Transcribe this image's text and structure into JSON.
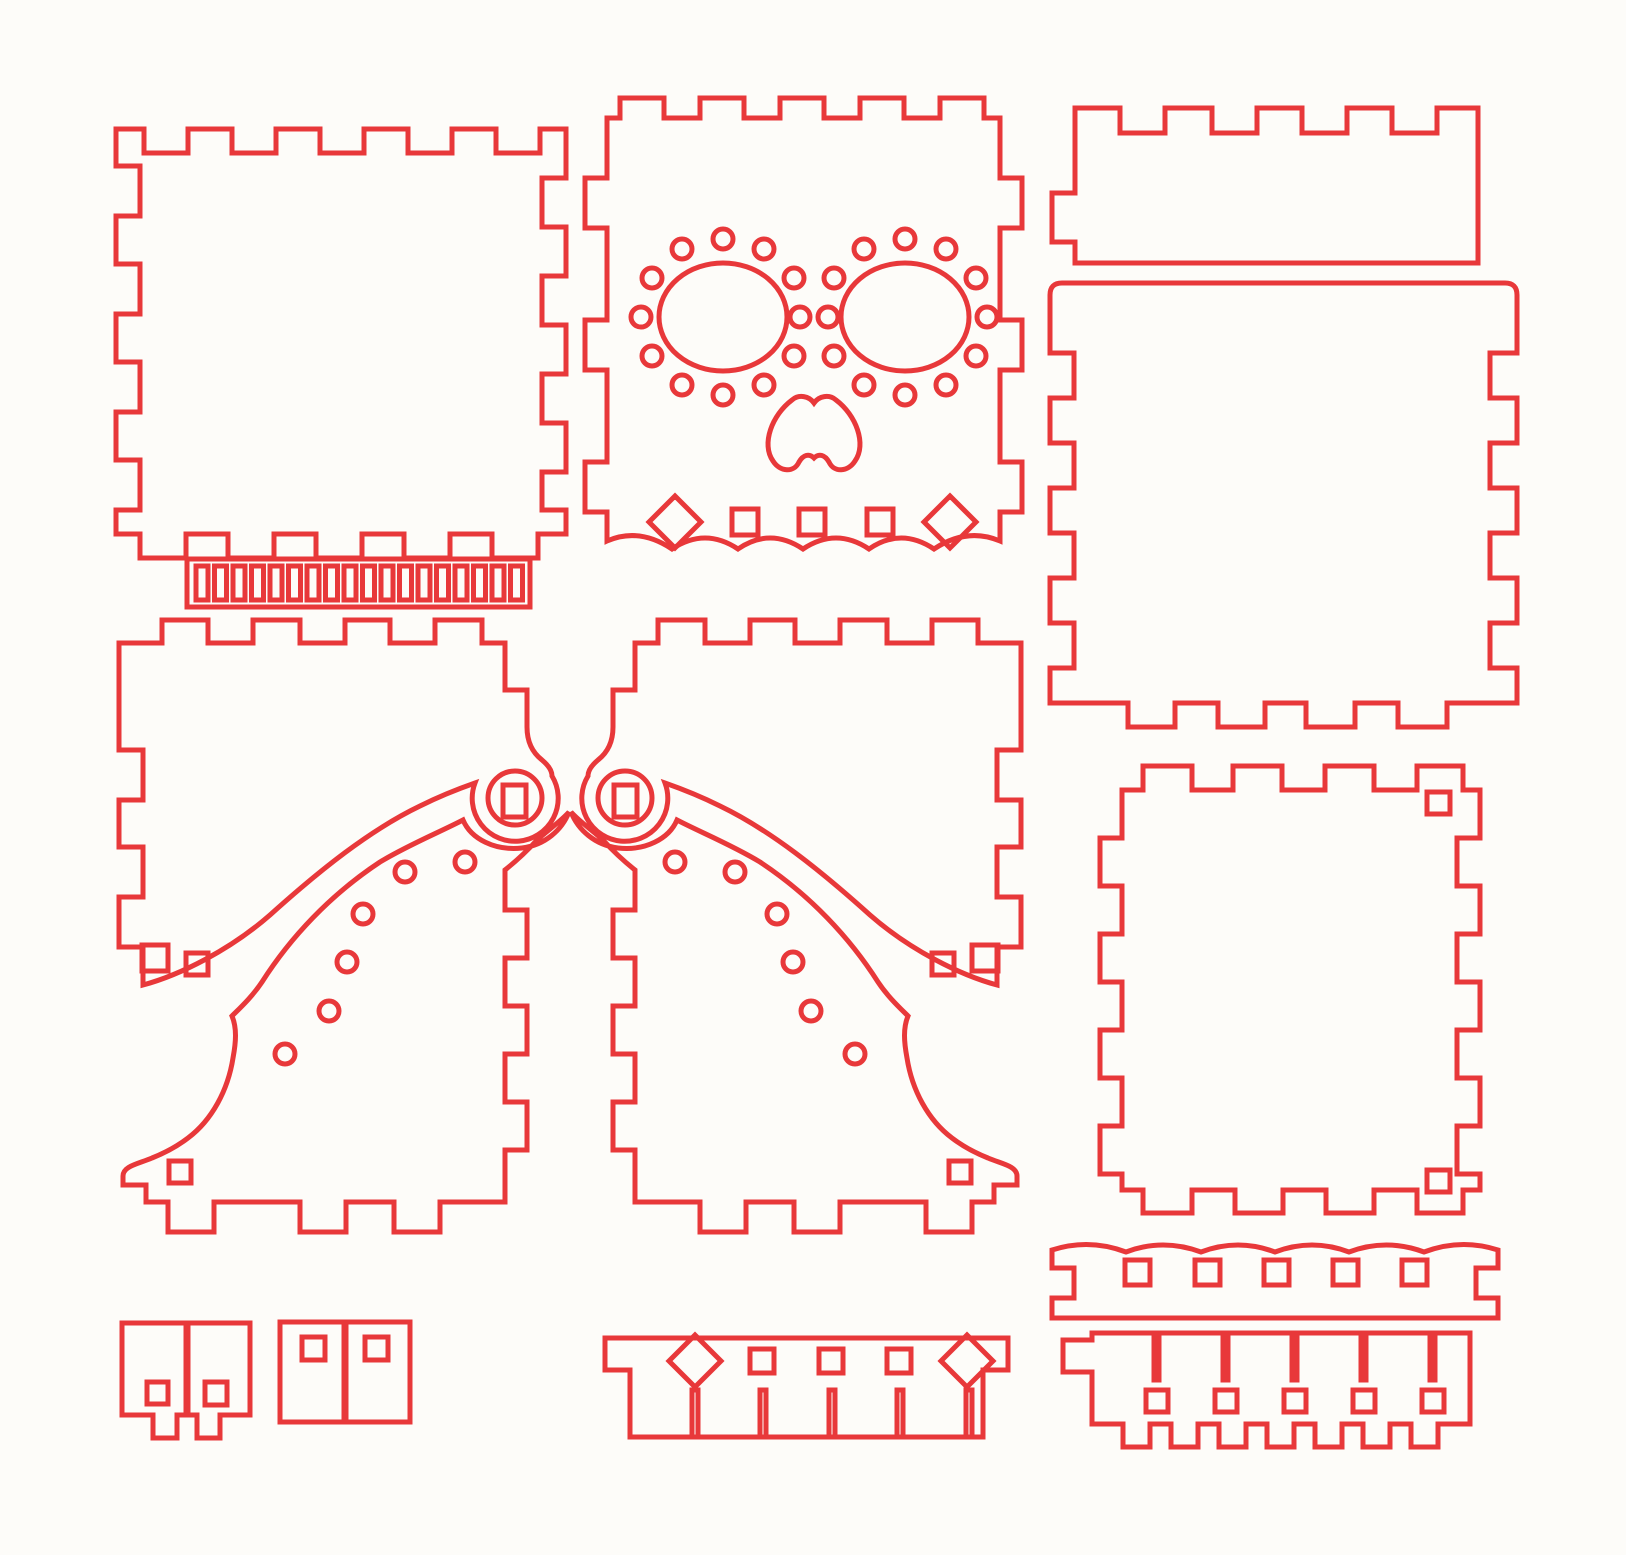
{
  "canvas": {
    "width": 1626,
    "height": 1555,
    "viewBox": "0 0 1626 1555",
    "background": "#fdfcf9"
  },
  "line": {
    "color": "#e8383a",
    "width": 5
  },
  "sheet": {
    "kind": "laser-cut-template",
    "theme": "sugar-skull-box-kit",
    "pieces": [
      {
        "name": "panel-top-left",
        "path": "M116,129H144V153H188V129H232V153H276V129H320V153H364V129H408V153H452V129H496V153H540V129H566V178H542V227H566V276H542V325H566V374H542V423H566V472H542V510H566V534H538V558H492V534H450V558H404V534H362V558H316V534H274V558H228V534H186V558H140V534H116V510H140V460H116V412H140V362H116V314H140V264H116V216H140V166H116Z"
      },
      {
        "name": "hinge-strip-outline",
        "path": "M187,559H530V607H187Z"
      },
      {
        "name": "hinge-strip-slots",
        "path": "M196,566h12v34h-12z M214.5,566h12v34h-12z M233,566h12v34h-12z M251.5,566h12v34h-12z M270,566h12v34h-12z M288.5,566h12v34h-12z M307,566h12v34h-12z M325.5,566h12v34h-12z M344,566h12v34h-12z M362.5,566h12v34h-12z M381,566h12v34h-12z M399.5,566h12v34h-12z M418,566h12v34h-12z M436.5,566h12v34h-12z M455,566h12v34h-12z M473.5,566h12v34h-12z M492,566h12v34h-12z M510.5,566h12v34h-12z"
      },
      {
        "name": "skull-front-panel",
        "path": "M607,118H620V98H664V118H700V98H744V118H780V98H824V118H860V98H904V118H940V98H984V118H1000V178H1022V228H1000V320H1022V370H1000V462H1022V512H1000V541Q967,527 934,549Q901,527 869,549Q836,527 803,549Q770,527 738,549Q705,527 672,549Q639,527 607,541V512H585V462H607V370H585V320H607V228H585V178H607Z"
      },
      {
        "name": "skull-eye-left",
        "path": "M659,317a64,54 0 1 0 128,0a64,54 0 1 0 -128,0Z"
      },
      {
        "name": "skull-eye-right",
        "path": "M841,317a64,54 0 1 0 128,0a64,54 0 1 0 -128,0Z"
      },
      {
        "name": "skull-eye-dots-left",
        "path": "M784,356a10,10 0 1 0 20,0a10,10 0 1 0 -20,0Z M754,385a10,10 0 1 0 20,0a10,10 0 1 0 -20,0Z M713,395a10,10 0 1 0 20,0a10,10 0 1 0 -20,0Z M672,385a10,10 0 1 0 20,0a10,10 0 1 0 -20,0Z M642,356a10,10 0 1 0 20,0a10,10 0 1 0 -20,0Z M631,317a10,10 0 1 0 20,0a10,10 0 1 0 -20,0Z M642,278a10,10 0 1 0 20,0a10,10 0 1 0 -20,0Z M672,249a10,10 0 1 0 20,0a10,10 0 1 0 -20,0Z M713,239a10,10 0 1 0 20,0a10,10 0 1 0 -20,0Z M754,249a10,10 0 1 0 20,0a10,10 0 1 0 -20,0Z M784,278a10,10 0 1 0 20,0a10,10 0 1 0 -20,0Z"
      },
      {
        "name": "skull-eye-dots-right",
        "path": "M977,317a10,10 0 1 0 20,0a10,10 0 1 0 -20,0Z M966,356a10,10 0 1 0 20,0a10,10 0 1 0 -20,0Z M936,385a10,10 0 1 0 20,0a10,10 0 1 0 -20,0Z M895,395a10,10 0 1 0 20,0a10,10 0 1 0 -20,0Z M854,385a10,10 0 1 0 20,0a10,10 0 1 0 -20,0Z M824,356a10,10 0 1 0 20,0a10,10 0 1 0 -20,0Z M824,278a10,10 0 1 0 20,0a10,10 0 1 0 -20,0Z M854,249a10,10 0 1 0 20,0a10,10 0 1 0 -20,0Z M895,239a10,10 0 1 0 20,0a10,10 0 1 0 -20,0Z M936,249a10,10 0 1 0 20,0a10,10 0 1 0 -20,0Z M966,278a10,10 0 1 0 20,0a10,10 0 1 0 -20,0Z"
      },
      {
        "name": "skull-center-dots",
        "path": "M790,317a10,10 0 1 0 20,0a10,10 0 1 0 -20,0Z M818,317a10,10 0 1 0 20,0a10,10 0 1 0 -20,0Z"
      },
      {
        "name": "skull-nose",
        "path": "M814,403C809,396 799,394 792,400C772,415 761,444 773,461C780,472 794,473 799,462C803,455 809,453 814,458C819,453 825,455 829,462C834,473 848,472 855,461C867,444 856,415 836,400C829,394 819,396 814,403Z"
      },
      {
        "name": "skull-bottom-holes",
        "path": "M675,496L701,522L675,548L649,522Z M732,509h26v26h-26z M799,509h26v26h-26z M867,509h26v26h-26z M950,496L976,522L950,548L924,522Z"
      },
      {
        "name": "lid-side-panel",
        "path": "M1075,263V242H1052V193H1075V108H1120V133H1165V108H1212V133H1257V108H1302V133H1347V108H1392V133H1437V108H1478V263Z"
      },
      {
        "name": "lid-top-panel",
        "path": "M1062,283H1505Q1517,283 1517,295V353H1490V398H1517V443H1490V488H1517V533H1490V578H1517V623H1490V668H1517V703H1447V727H1398V703H1355V727H1306V703H1265V727H1218V703H1175V727H1128V703H1050V668H1074V623H1050V578H1074V533H1050V488H1074V443H1050V398H1074V353H1050V295Q1050,283 1062,283Z"
      },
      {
        "name": "panel-mid-left",
        "path": "M119,643H162V620H208V643H253V620H300V643H345V620H390V643H435V620H482V643H505V690H527V727C527,742 533,753 542,760C548,765 552,770 552,776A43,43 0 1 1 475,783C455,790 440,796 420,806C370,830 320,870 270,915C230,950 180,975 143,985V947H119V897H143V847H119V800H143V750H119V643Z"
      },
      {
        "name": "panel-mid-left-holes",
        "path": "M142,945h26v26h-26z M186,953h22v22h-22z"
      },
      {
        "name": "bell-piece-left",
        "path": "M569,812C562,830 545,845 522,848C495,851 471,839 463,820C440,832 408,845 380,862C330,895 290,938 262,982C252,997 240,1008 232,1016C237,1028 236,1042 233,1058C228,1090 212,1120 188,1138C175,1148 162,1154 152,1158C138,1164 123,1166 123,1176V1185H146V1202H168V1232H214V1202H300V1232H346V1202H394V1232H440V1202H505V1150H527V1102H505V1054H527V1006H505V958H527V910H505V870C515,862 528,850 537,840C548,830 560,822 569,812Z"
      },
      {
        "name": "bell-piece-left-holes",
        "path": "M455,862a10,10 0 1 0 20,0a10,10 0 1 0 -20,0Z M395,872a10,10 0 1 0 20,0a10,10 0 1 0 -20,0Z M353,914a10,10 0 1 0 20,0a10,10 0 1 0 -20,0Z M337,962a10,10 0 1 0 20,0a10,10 0 1 0 -20,0Z M319,1011a10,10 0 1 0 20,0a10,10 0 1 0 -20,0Z M275,1054a10,10 0 1 0 20,0a10,10 0 1 0 -20,0Z M169,1161h22v22h-22z"
      },
      {
        "name": "hinge-washer-left",
        "path": "M488,798a27,27 0 1 0 54,0a27,27 0 1 0 -54,0Z M503,785h23v32h-23z"
      },
      {
        "name": "panel-mid-right",
        "path": "M1021,643H978V620H932V643H887V620H840V643H795V620H750V643H705V620H658V643H635V690H613V727C613,742 607,753 598,760C592,765 588,770 588,776A43,43 0 1 0 665,783C685,790 700,796 720,806C770,830 820,870 870,915C910,950 960,975 997,985V947H1021V897H997V847H1021V800H997V750H1021V643Z"
      },
      {
        "name": "panel-mid-right-holes",
        "path": "M972,945h26v26h-26z M932,953h22v22h-22z"
      },
      {
        "name": "bell-piece-right",
        "path": "M571,812C578,830 595,845 618,848C645,851 669,839 677,820C700,832 732,845 760,862C810,895 850,938 878,982C888,997 900,1008 908,1016C903,1028 904,1042 907,1058C912,1090 928,1120 952,1138C965,1148 978,1154 988,1158C1002,1164 1017,1166 1017,1176V1185H994V1202H972V1232H926V1202H840V1232H794V1202H746V1232H700V1202H635V1150H613V1102H635V1054H613V1006H635V958H613V910H635V870C625,862 612,850 603,840C592,830 580,822 571,812Z"
      },
      {
        "name": "bell-piece-right-holes",
        "path": "M665,862a10,10 0 1 0 20,0a10,10 0 1 0 -20,0Z M725,872a10,10 0 1 0 20,0a10,10 0 1 0 -20,0Z M767,914a10,10 0 1 0 20,0a10,10 0 1 0 -20,0Z M783,962a10,10 0 1 0 20,0a10,10 0 1 0 -20,0Z M801,1011a10,10 0 1 0 20,0a10,10 0 1 0 -20,0Z M845,1054a10,10 0 1 0 20,0a10,10 0 1 0 -20,0Z M949,1161h22v22h-22z"
      },
      {
        "name": "hinge-washer-right",
        "path": "M598,798a27,27 0 1 0 54,0a27,27 0 1 0 -54,0Z M614,785h23v32h-23z"
      },
      {
        "name": "panel-right-lower",
        "path": "M1122,790H1143V766H1192V790H1233V766H1282V790H1325V766H1374V790H1417V766H1463V790H1480V838H1457V886H1480V934H1457V982H1480V1030H1457V1078H1480V1126H1457V1174H1480V1190H1463V1213H1417V1190H1374V1213H1326V1190H1283V1213H1235V1190H1192V1213H1143V1190H1122V1174H1100V1126H1122V1078H1100V1030H1122V982H1100V934H1122V886H1100V838H1122Z"
      },
      {
        "name": "panel-right-lower-holes",
        "path": "M1427,792h23v22h-23z M1427,1170h23v22h-23z"
      },
      {
        "name": "scallop-strip",
        "path": "M1052,1250Q1089,1238 1126,1252Q1163,1238 1201,1252Q1238,1238 1275,1252Q1312,1238 1349,1252Q1386,1238 1424,1252Q1461,1238 1498,1250V1268H1476V1298H1498V1318H1052V1298H1074V1268H1052Z"
      },
      {
        "name": "scallop-strip-holes",
        "path": "M1125,1260h25v25h-25z M1195,1260h25v25h-25z M1264,1260h25v25h-25z M1333,1260h25v25h-25z M1402,1260h25v25h-25z"
      },
      {
        "name": "key-comb",
        "path": "M1092,1333H1470V1424H1438V1447H1411V1424H1390V1447H1363V1424H1342V1447H1315V1424H1294V1447H1267V1424H1246V1447H1219V1424H1198V1447H1171V1424H1150V1447H1123V1424H1092V1372H1063V1340H1092Z"
      },
      {
        "name": "key-comb-slits",
        "path": "M1154,1333h5v47h-5z M1223,1333h5v47h-5z M1292,1333h5v47h-5z M1361,1333h5v47h-5z M1430,1333h5v47h-5z"
      },
      {
        "name": "key-comb-holes",
        "path": "M1146,1390h22v22h-22z M1215,1390h22v22h-22z M1284,1390h22v22h-22z M1353,1390h22v22h-22z M1422,1390h22v22h-22z"
      },
      {
        "name": "slot-strip",
        "path": "M605,1338H1008V1370H983V1437H630V1370H605Z"
      },
      {
        "name": "slot-strip-slits",
        "path": "M692,1390h6v47h-6z M760,1390h6v47h-6z M829,1390h6v47h-6z M897,1390h6v47h-6z M966,1390h6v47h-6z"
      },
      {
        "name": "slot-strip-holes",
        "path": "M695,1335L721,1361L695,1387L669,1361Z M750,1349h24v24h-24z M819,1349h24v24h-24z M887,1349h24v24h-24z M967,1335L993,1361L967,1387L941,1361Z"
      },
      {
        "name": "foot-block-a1",
        "path": "M122,1323H186V1415H177V1438H153V1415H122Z M147,1382h21v22h-21z"
      },
      {
        "name": "foot-block-a2",
        "path": "M188,1323H250V1415H220V1438H197V1415H188Z M205,1382h22v23h-22z"
      },
      {
        "name": "foot-block-b1",
        "path": "M280,1322H344V1422H280Z M302,1337h23v23h-23z"
      },
      {
        "name": "foot-block-b2",
        "path": "M346,1322H410V1422H346Z M365,1337h23v23h-23z"
      }
    ]
  }
}
